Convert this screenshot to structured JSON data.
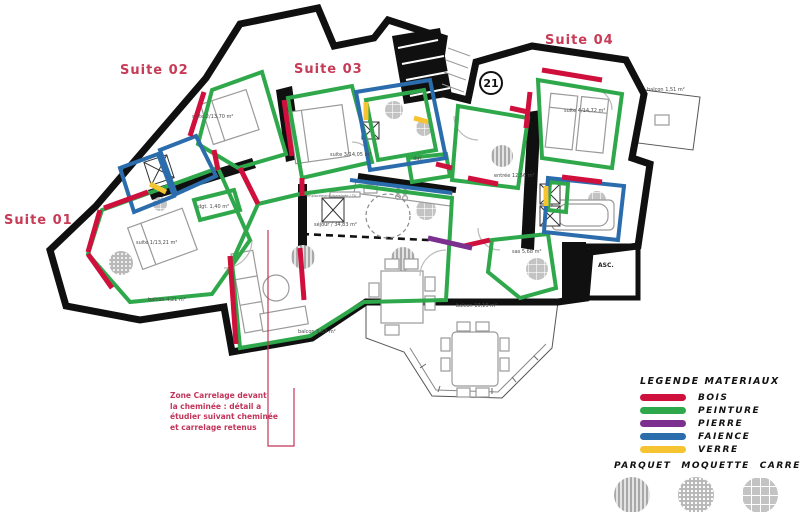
{
  "plan": {
    "suite_labels": [
      "Suite 01",
      "Suite 02",
      "Suite 03",
      "Suite 04"
    ],
    "unit_number": "21",
    "rooms": {
      "suite1": "suite 1/13,21 m²",
      "suite2": "suite 2/13,70 m²",
      "suite3": "suite 3/14,05 m²",
      "suite4": "suite 4/14,72 m²",
      "entree": "entrée 12,56 m²",
      "sejour": "séjour / 34,83 m²",
      "sas": "sas 5,68 m²",
      "dgt1": "dgt. 1,40 m²",
      "dgt2": "dgt.",
      "balcon_suite1": "balcon 4,21 m²",
      "balcon_sejour_ouest": "balcon 5,63 m²",
      "balcon_sejour_sud": "balcon 10,19 m²",
      "balcon_suite4": "balcon 1,51 m²",
      "ascenseur": "ASC.",
      "cheminee_note": "emplacement cheminée / TV"
    }
  },
  "annotation": {
    "lines": [
      "Zone Carrelage devant",
      "la cheminée : détail a",
      "étudier suivant cheminée",
      "et carrelage retenus"
    ]
  },
  "legend": {
    "title": "LEGENDE MATERIAUX",
    "materials": [
      {
        "label": "BOIS",
        "color": "#cf0f3c"
      },
      {
        "label": "PEINTURE",
        "color": "#2fa84b"
      },
      {
        "label": "PIERRE",
        "color": "#7b2f8e"
      },
      {
        "label": "FAIENCE",
        "color": "#2b6cad"
      },
      {
        "label": "VERRE",
        "color": "#f6c431"
      }
    ],
    "floors": [
      {
        "label": "PARQUET",
        "pattern": "stripes"
      },
      {
        "label": "MOQUETTE",
        "pattern": "dots"
      },
      {
        "label": "CARRELAGE",
        "pattern": "grid"
      }
    ]
  }
}
